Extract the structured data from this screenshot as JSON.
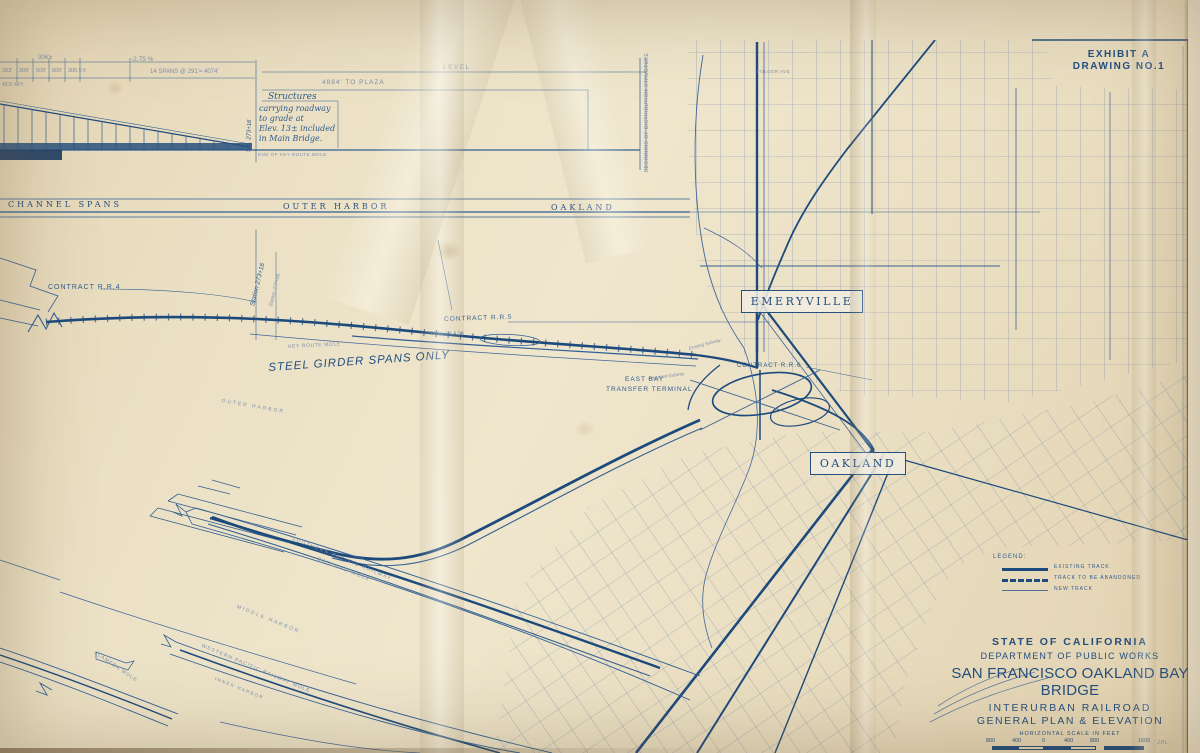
{
  "exhibit": {
    "line1": "EXHIBIT A",
    "line2": "DRAWING NO.1"
  },
  "elevation": {
    "level": "LEVEL",
    "to_plaza": "4884' TO PLAZA",
    "grade": "-2.75 %",
    "spans": "14 SPANS @ 291'= 4074'",
    "d306": "306'±",
    "d1": "283'",
    "d2": "309'",
    "d3": "509'",
    "d4": "509'",
    "d5": "306.5'±",
    "small_dims": "43.5' 49'±",
    "note": [
      "Structures",
      "carrying roadway",
      "to grade at",
      "Elev. 13± included",
      "in Main Bridge."
    ],
    "sta": "Sta. 273+16",
    "end_mole": "END OF KEY ROUTE MOLE",
    "begin_dist": "BEGINNING OF DISTRIBUTION STRUCTURE"
  },
  "band": {
    "channel": "CHANNEL SPANS",
    "outer": "OUTER HARBOR",
    "oakland": "OAKLAND"
  },
  "plan": {
    "rr4": "CONTRACT R.R.4",
    "rr5": "CONTRACT R.R.5",
    "rr6": "CONTRACT R.R.6",
    "sta273": "Station 273+16",
    "sta277": "Station 277+96",
    "key_mole": "KEY ROUTE MOLE",
    "steel": "STEEL GIRDER SPANS ONLY",
    "toll": "TOLL PLAZA",
    "ebt1": "EAST BAY",
    "ebt2": "TRANSFER TERMINAL",
    "exist_sub": "Existing Subway",
    "prop_sub": "Proposed Subway",
    "emeryville": "EMERYVILLE",
    "oakland": "OAKLAND",
    "outer_harbor": "OUTER HARBOR",
    "middle_harbor": "MIDDLE HARBOR",
    "inner_harbor": "INNER HARBOR",
    "sp1": "SOUTHERN PACIFIC RAILWAY",
    "sp2": "OAKLAND MOLE",
    "wp": "WESTERN PACIFIC RAILWAY MOLE",
    "alameda": "ALAMEDA MOLE",
    "folger": "FOLGER AVE"
  },
  "legend": {
    "title": "LEGEND:",
    "items": [
      {
        "label": "EXISTING TRACK",
        "style": "solid-heavy"
      },
      {
        "label": "TRACK TO BE ABANDONED",
        "style": "dashed-heavy"
      },
      {
        "label": "NEW TRACK",
        "style": "thin"
      }
    ]
  },
  "title_block": {
    "state": "STATE OF CALIFORNIA",
    "dept": "DEPARTMENT OF PUBLIC WORKS",
    "title": "SAN FRANCISCO OAKLAND BAY BRIDGE",
    "sub1": "INTERURBAN RAILROAD",
    "sub2": "GENERAL PLAN & ELEVATION",
    "scale_label": "HORIZONTAL SCALE IN FEET",
    "scale": [
      "800",
      "400",
      "0",
      "400",
      "800",
      "1600"
    ],
    "date": "NOVEMBER  1933",
    "initials": "J.P.L."
  },
  "colors": {
    "ink": "#2f5c90",
    "ink_heavy": "#1d4a7c",
    "paper": "#eadfc2"
  }
}
